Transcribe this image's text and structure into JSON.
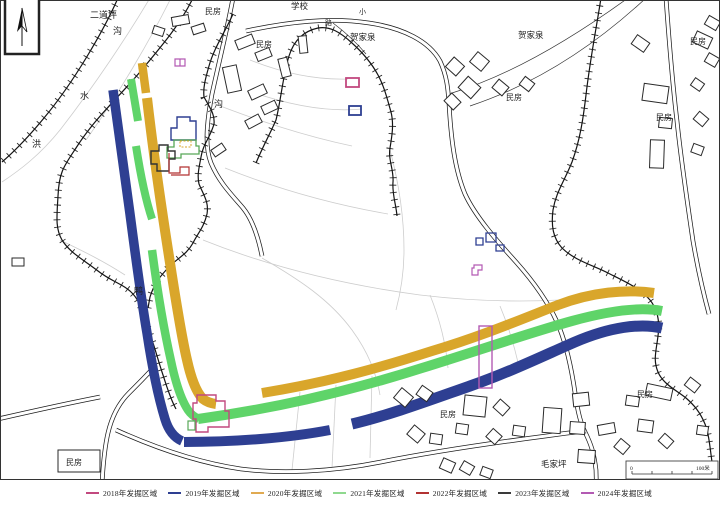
{
  "legend": {
    "items": [
      {
        "label": "2018年发掘区域",
        "color": "#c2497f"
      },
      {
        "label": "2019年发掘区域",
        "color": "#2e3f92"
      },
      {
        "label": "2020年发掘区域",
        "color": "#e0aa52"
      },
      {
        "label": "2021年发掘区域",
        "color": "#8fd98f"
      },
      {
        "label": "2022年发掘区域",
        "color": "#b23232"
      },
      {
        "label": "2023年发掘区域",
        "color": "#3a3a3a"
      },
      {
        "label": "2024年发掘区域",
        "color": "#b35ab3"
      }
    ]
  },
  "scale_bar": {
    "zero": "0",
    "max": "100米"
  },
  "colors": {
    "y2018": "#c2497f",
    "y2019": "#2e3f92",
    "y2020": "#d9a62b",
    "y2021": "#5fd469",
    "y2022": "#b23232",
    "y2023": "#333333",
    "y2024": "#b35ab3",
    "green_outline": "#57a857",
    "terrain": "#141414",
    "field": "#cdcdcd",
    "road": "#1c1c1c"
  },
  "map_labels": [
    {
      "t": "二道坪",
      "x": 90,
      "y": 18,
      "s": 9
    },
    {
      "t": "民房",
      "x": 205,
      "y": 14,
      "s": 8
    },
    {
      "t": "学校",
      "x": 291,
      "y": 9,
      "s": 8.5
    },
    {
      "t": "小",
      "x": 359,
      "y": 14,
      "s": 7
    },
    {
      "t": "路",
      "x": 325,
      "y": 25,
      "s": 7
    },
    {
      "t": "民房",
      "x": 256,
      "y": 47,
      "s": 8
    },
    {
      "t": "贺家泉",
      "x": 350,
      "y": 40,
      "s": 8.5
    },
    {
      "t": "贺家泉",
      "x": 518,
      "y": 38,
      "s": 8.5
    },
    {
      "t": "民房",
      "x": 506,
      "y": 100,
      "s": 8
    },
    {
      "t": "民房",
      "x": 690,
      "y": 44,
      "s": 8
    },
    {
      "t": "民房",
      "x": 656,
      "y": 120,
      "s": 8
    },
    {
      "t": "沟",
      "x": 214,
      "y": 107,
      "s": 9
    },
    {
      "t": "沟",
      "x": 113,
      "y": 34,
      "s": 9
    },
    {
      "t": "水",
      "x": 80,
      "y": 99,
      "s": 9
    },
    {
      "t": "洪",
      "x": 32,
      "y": 147,
      "s": 9
    },
    {
      "t": "鸭",
      "x": 134,
      "y": 294,
      "s": 9
    },
    {
      "t": "民房",
      "x": 66,
      "y": 465,
      "s": 8
    },
    {
      "t": "民房",
      "x": 440,
      "y": 417,
      "s": 8
    },
    {
      "t": "民房",
      "x": 637,
      "y": 397,
      "s": 8
    },
    {
      "t": "毛家坪",
      "x": 541,
      "y": 467,
      "s": 8.5
    }
  ],
  "streams": [
    "M118,-2 C104,30 74,82 44,118 C30,135 16,150 2,162",
    "M193,-2 C180,25 160,48 140,72 C118,98 95,118 76,148 C64,166 59,172 58,196 C57,215 55,228 62,240 C70,253 84,260 98,271 C112,282 124,284 133,294 C142,304 144,318 150,334 C155,348 158,360 163,375 C167,387 170,398 176,409",
    "M233,14 C224,34 214,48 209,66 C205,80 203,88 204,97 C210,108 215,114 214,124 C210,138 203,144 201,157 C199,168 197,175 199,184 C204,196 209,202 207,214 C204,227 198,233 193,243 C187,254 178,258 170,266 C160,276 154,284 150,297 L148,308",
    "M256,163 C263,146 270,134 276,120 C281,100 283,75 289,56 C294,40 304,31 318,28 C330,26 340,32 352,43 C362,52 371,62 378,75 C384,86 387,98 391,112 C394,124 392,136 390,148 C388,160 394,170 393,182 C392,194 396,204 397,216",
    "M601,-2 C596,30 590,60 586,95 C583,120 580,140 572,162 C564,182 556,192 553,210 C551,226 553,238 562,248 C574,260 592,265 608,273 C624,281 640,288 650,300 C658,310 660,322 658,336 C656,352 653,360 658,372 C663,384 676,390 686,398 C694,405 700,412 705,424 C709,434 710,448 712,462"
  ],
  "roads": [
    "M233,-2 C227,30 219,62 212,94 C206,126 205,148 211,163 C219,182 231,194 243,208 C252,219 258,236 262,256",
    "M246,31 C288,22 330,17 369,23 C403,28 429,41 440,61 C447,76 448,89 449,103 C451,140 455,170 465,194 C475,216 497,241 516,262 C533,281 547,300 557,322 C565,340 570,361 574,386 C577,406 579,420 585,432 C591,444 594,453 596,470 L597,508",
    "M101,508 C102,472 104,450 108,433 C112,416 119,403 129,393 C138,384 147,375 156,365",
    "M-2,419 C33,411 64,404 100,397",
    "M116,430 C158,449 200,463 241,469 C281,474 331,472 381,462 C431,452 500,442 546,436 C566,433 576,432 586,431",
    "M666,-2 C669,40 672,80 677,121 C681,160 687,200 693,241 C698,270 703,292 709,314"
  ],
  "thin_paths": [
    "M628,-2 C570,40 508,76 452,93",
    "M646,-2 C590,50 530,86 470,106",
    "M333,23 C345,32 356,42 366,54"
  ],
  "field_lines": [
    "M150,-2 C128,35 95,85 60,130 C40,155 20,170 2,182",
    "M170,0 C150,40 120,92 86,140",
    "M60,240 C85,252 105,262 125,275",
    "M205,100 C250,118 300,135 352,146",
    "M225,168 C275,188 330,204 388,214",
    "M203,240 C258,262 330,283 420,295 C470,301 520,302 560,300",
    "M262,258 C300,280 330,300 352,330 C368,352 376,372 380,395",
    "M390,150 C398,180 404,215 404,250 C404,275 400,295 396,310",
    "M300,392 L292,470",
    "M336,385 L332,468",
    "M372,376 L370,458",
    "M430,295 C440,320 446,345 448,368",
    "M500,306 C510,330 516,352 520,372",
    "M250,60 C285,74 318,80 348,79",
    "M252,92 C292,106 330,112 362,109"
  ],
  "stripes": [
    {
      "year": "2019",
      "d": "M113,90 C119,135 125,175 130,214 C135,252 141,298 147,333 C152,366 158,396 165,419 C168,429 173,437 182,441",
      "w": 9.5
    },
    {
      "year": "2021",
      "d": "M131,79 L138,121",
      "w": 8
    },
    {
      "year": "2021",
      "d": "M136,146 C141,178 147,204 152,219",
      "w": 8
    },
    {
      "year": "2021",
      "d": "M152,250 C157,288 164,330 171,361 C175,380 180,398 188,410 Q192,416 199,419",
      "w": 8.5
    },
    {
      "year": "2020",
      "d": "M142,63 L146,93",
      "w": 8.5
    },
    {
      "year": "2020",
      "d": "M147,98 C153,150 161,205 168,250 C173,282 180,330 187,360 C191,378 196,392 203,399 Q208,403 216,404",
      "w": 10
    },
    {
      "year": "2020",
      "d": "M262,393 C330,382 382,367 432,351 C482,336 522,319 558,305 C592,292 626,289 654,293",
      "w": 10
    },
    {
      "year": "2021",
      "d": "M198,419 C270,409 340,394 422,368 C480,350 532,332 572,321 C612,310 642,307 662,311",
      "w": 10
    },
    {
      "year": "2019",
      "d": "M184,442 C235,442 288,438 330,430",
      "w": 10
    },
    {
      "year": "2019",
      "d": "M352,424 C390,415 430,400 470,386 C510,372 545,355 575,342 C610,327 640,323 662,328",
      "w": 11
    }
  ],
  "houses": [
    [
      172,
      16,
      17,
      9,
      -10
    ],
    [
      192,
      25,
      13,
      8,
      -18
    ],
    [
      153,
      27,
      11,
      8,
      18
    ],
    [
      236,
      37,
      18,
      10,
      -22
    ],
    [
      256,
      50,
      15,
      9,
      -22
    ],
    [
      225,
      66,
      14,
      26,
      -12
    ],
    [
      249,
      87,
      17,
      10,
      -25
    ],
    [
      262,
      103,
      15,
      9,
      -25
    ],
    [
      299,
      36,
      8,
      17,
      -6
    ],
    [
      280,
      58,
      9,
      19,
      -14
    ],
    [
      246,
      117,
      15,
      9,
      -28
    ],
    [
      212,
      146,
      13,
      8,
      -34
    ],
    [
      448,
      60,
      14,
      13,
      42
    ],
    [
      472,
      55,
      15,
      13,
      40
    ],
    [
      461,
      80,
      17,
      15,
      42
    ],
    [
      446,
      96,
      13,
      11,
      45
    ],
    [
      494,
      82,
      13,
      11,
      40
    ],
    [
      521,
      79,
      12,
      10,
      38
    ],
    [
      633,
      38,
      15,
      11,
      35
    ],
    [
      694,
      34,
      17,
      12,
      25
    ],
    [
      706,
      18,
      13,
      10,
      30
    ],
    [
      643,
      85,
      25,
      17,
      8
    ],
    [
      706,
      55,
      12,
      10,
      30
    ],
    [
      692,
      80,
      11,
      9,
      35
    ],
    [
      659,
      118,
      13,
      10,
      6
    ],
    [
      695,
      114,
      12,
      10,
      40
    ],
    [
      650,
      140,
      14,
      28,
      2
    ],
    [
      692,
      145,
      11,
      9,
      20
    ],
    [
      12,
      258,
      12,
      8,
      0
    ],
    [
      396,
      391,
      15,
      13,
      40
    ],
    [
      418,
      388,
      13,
      11,
      35
    ],
    [
      464,
      396,
      22,
      20,
      6
    ],
    [
      495,
      402,
      13,
      11,
      42
    ],
    [
      456,
      424,
      12,
      10,
      8
    ],
    [
      409,
      428,
      14,
      12,
      40
    ],
    [
      430,
      434,
      12,
      10,
      8
    ],
    [
      488,
      431,
      12,
      11,
      42
    ],
    [
      513,
      426,
      12,
      10,
      8
    ],
    [
      543,
      408,
      18,
      25,
      4
    ],
    [
      573,
      393,
      16,
      13,
      -6
    ],
    [
      441,
      460,
      13,
      11,
      24
    ],
    [
      461,
      463,
      12,
      10,
      30
    ],
    [
      481,
      468,
      11,
      9,
      20
    ],
    [
      626,
      396,
      13,
      10,
      8
    ],
    [
      646,
      386,
      26,
      12,
      12
    ],
    [
      686,
      380,
      13,
      10,
      38
    ],
    [
      638,
      420,
      15,
      12,
      8
    ],
    [
      660,
      436,
      12,
      10,
      42
    ],
    [
      697,
      426,
      11,
      9,
      8
    ],
    [
      570,
      422,
      15,
      12,
      4
    ],
    [
      598,
      424,
      17,
      10,
      -10
    ],
    [
      616,
      441,
      12,
      11,
      40
    ],
    [
      578,
      450,
      17,
      13,
      4
    ],
    [
      58,
      450,
      42,
      22,
      0
    ]
  ],
  "features": [
    {
      "name": "excavation-2024-pair",
      "type": "path",
      "d": "M175,59 h10 v7 h-10 z M180,59 v7",
      "stroke": "y2024",
      "sw": 1.2
    },
    {
      "name": "excavation-2018-rect",
      "type": "rect",
      "x": 346,
      "y": 78,
      "w": 13,
      "h": 9,
      "stroke": "y2018",
      "sw": 1.8
    },
    {
      "name": "excavation-2019-rect",
      "type": "rect",
      "x": 349,
      "y": 106,
      "w": 12,
      "h": 9,
      "stroke": "y2019",
      "sw": 1.8
    },
    {
      "name": "excavation-2019-squares",
      "type": "path",
      "d": "M476,238 h7 v7 h-7 z M486,233 h10 v9 h-10 z M496,245 h8 v6 h-8 z",
      "stroke": "y2019",
      "sw": 1.3
    },
    {
      "name": "excavation-2024-small",
      "type": "path",
      "d": "M474,265 h8 v5 h-4 v5 h-6 v-7 h2 z",
      "stroke": "y2024",
      "sw": 1.2
    },
    {
      "name": "excavation-2024-long-rect",
      "type": "rect",
      "x": 479,
      "y": 326,
      "w": 13,
      "h": 62,
      "stroke": "y2024",
      "sw": 1.4
    },
    {
      "name": "excavation-2018-area",
      "type": "path",
      "d": "M197,395 L216,395 L216,401 L225,401 L225,411 L229,411 L229,427 L208,427 L208,432 L196,432 L196,419 L193,419 L193,403 L197,403 Z",
      "stroke": "y2018",
      "sw": 1.4
    },
    {
      "name": "excavation-2021-small-rect",
      "type": "rect",
      "x": 188,
      "y": 421,
      "w": 7,
      "h": 9,
      "stroke": "green_outline",
      "sw": 1.2
    },
    {
      "name": "excavation-2019-area",
      "type": "path",
      "d": "M171,128 L177,128 L177,117 L190,117 L190,121 L196,121 L196,140 L171,140 Z",
      "stroke": "y2019",
      "sw": 1.4
    },
    {
      "name": "excavation-2021-area",
      "type": "path",
      "d": "M167,147 L174,147 L174,140 L196,140 L196,146 L199,146 L199,154 L181,154 L181,158 L167,158 Z",
      "stroke": "green_outline",
      "sw": 1.3
    },
    {
      "name": "excavation-2020-dashed-rect",
      "type": "rect",
      "x": 180,
      "y": 141,
      "w": 11,
      "h": 6,
      "stroke": "y2020",
      "sw": 1,
      "dash": "2,1.5"
    },
    {
      "name": "excavation-2023-area",
      "type": "path",
      "d": "M151,151 L159,151 L159,145 L168,145 L168,151 L175,151 L175,159 L169,159 L169,171 L157,171 L157,164 L151,164 Z",
      "stroke": "y2023",
      "sw": 1.4
    },
    {
      "name": "excavation-2022-area",
      "type": "path",
      "d": "M169,153 L169,173 L180,173 L180,167 L189,167 L189,175 L171,175",
      "stroke": "y2022",
      "sw": 1.2
    }
  ]
}
